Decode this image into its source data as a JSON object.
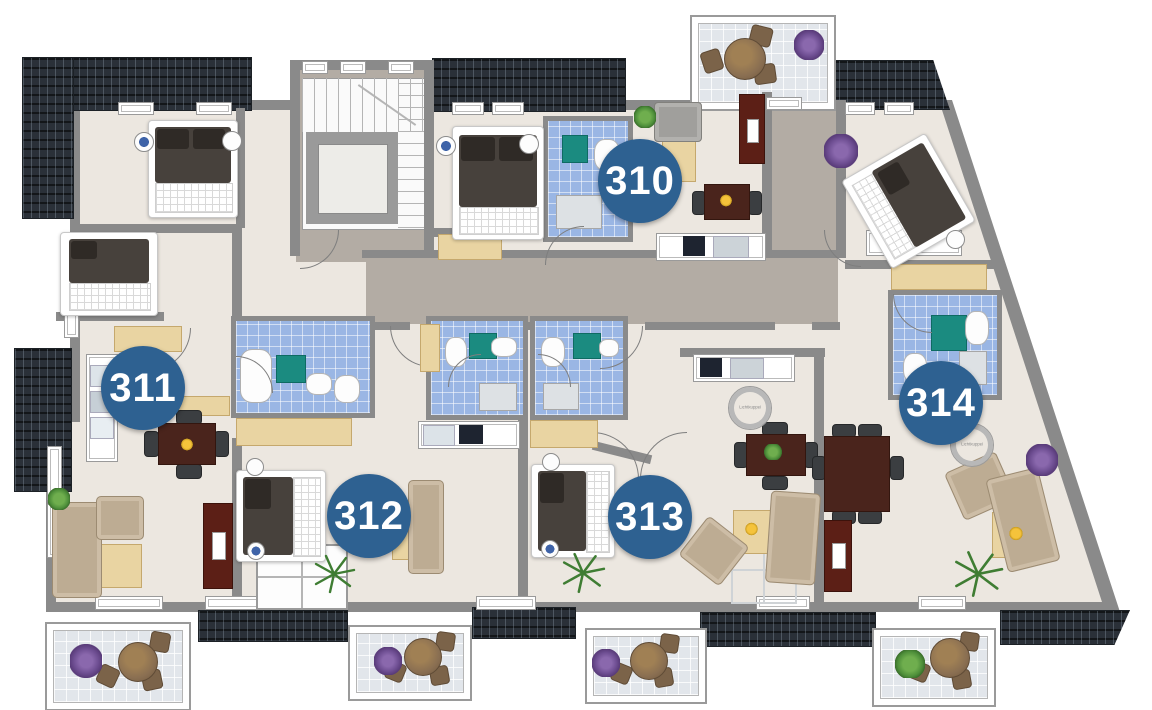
{
  "plan": {
    "type": "apartment-floor-plan",
    "apartments": [
      {
        "number": "310"
      },
      {
        "number": "311"
      },
      {
        "number": "312"
      },
      {
        "number": "313"
      },
      {
        "number": "314"
      }
    ],
    "skylights": [
      {
        "label": "Lichtkuppel"
      },
      {
        "label": "Lichtkuppel"
      }
    ]
  },
  "colors": {
    "badge": "#2e6191",
    "badge-text": "#ffffff",
    "roof": "#2a3038",
    "wall": "#8a8a8a",
    "floor": "#ece7e0",
    "corridor": "#b3aca4",
    "bath-tile": "#9ab6e4",
    "bath-mat": "#1b8b80",
    "wood": "#e9d4a2",
    "table-dark": "#4a241c",
    "sofa": "#bdac93",
    "sideboard": "#5c1f16",
    "balcony-floor": "#e2e6eb",
    "plant-purple": "#6f4f93",
    "plant-green": "#4e8f3a"
  }
}
